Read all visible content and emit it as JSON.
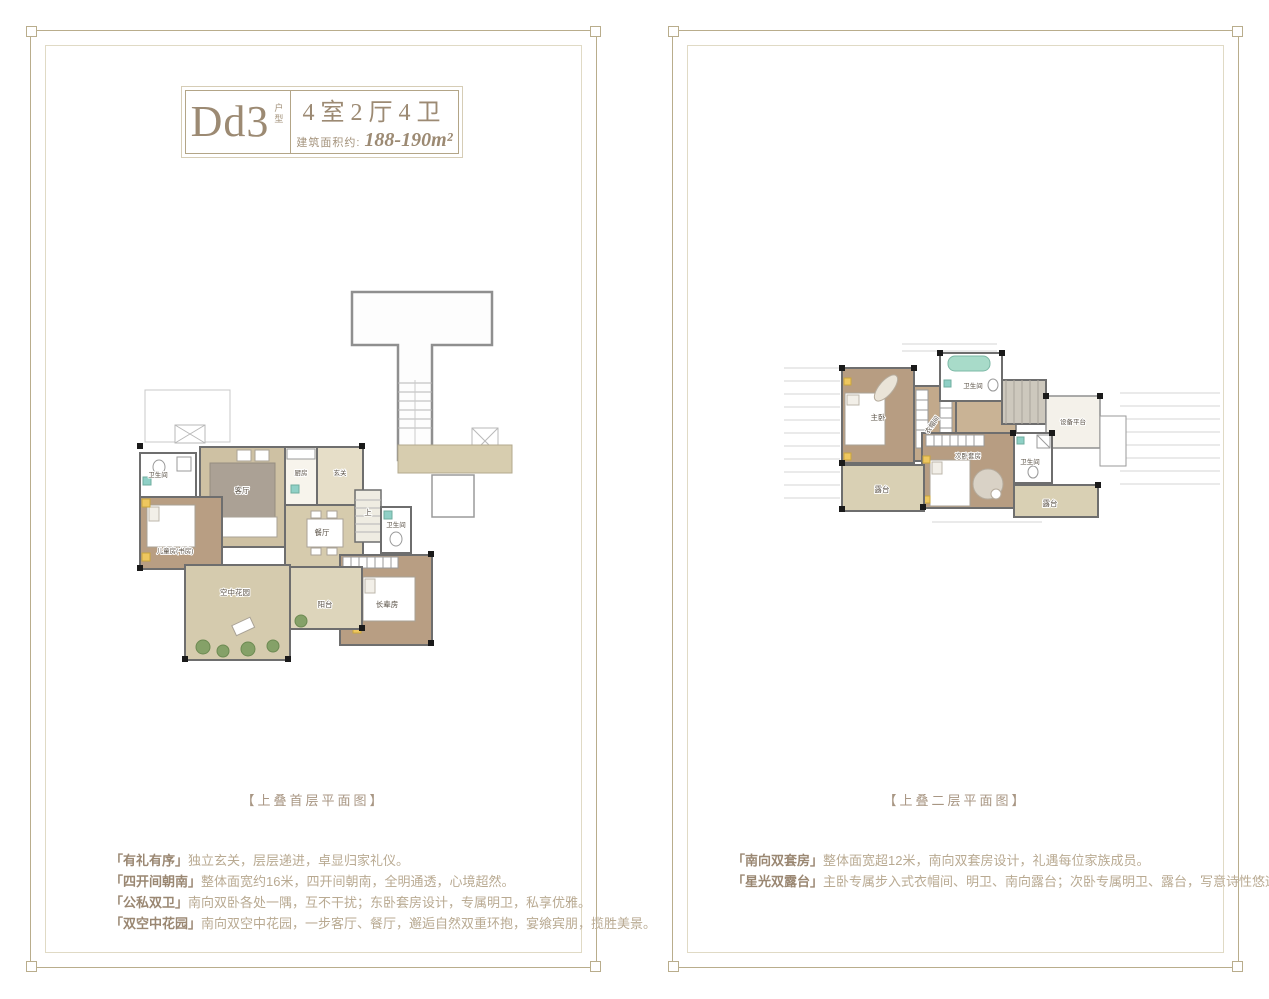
{
  "colors": {
    "frame_gold": "#b9ad8c",
    "frame_inner": "#e0dac5",
    "title_text": "#9c8a73",
    "feature_tag": "#9a8772",
    "feature_text": "#b9aa92",
    "caption_text": "#a89683",
    "wall": "#6e6e6e",
    "wood_floor": "#b79d82",
    "tan_floor": "#d6cbad",
    "plant_green": "#85a168",
    "accent_teal": "#8fd0c6",
    "accent_yellow": "#eec75f"
  },
  "left_panel": {
    "title_block": {
      "code": "Dd3",
      "code_suffix": "户型",
      "spec": "4室2厅4卫",
      "area_label": "建筑面积约:",
      "area_value": "188-190m²"
    },
    "caption": "【上叠首层平面图】",
    "features": [
      {
        "tag": "「有礼有序」",
        "text": "独立玄关，层层递进，卓显归家礼仪。"
      },
      {
        "tag": "「四开间朝南」",
        "text": "整体面宽约16米，四开间朝南，全明通透，心境超然。"
      },
      {
        "tag": "「公私双卫」",
        "text": "南向双卧各处一隅，互不干扰；东卧套房设计，专属明卫，私享优雅。"
      },
      {
        "tag": "「双空中花园」",
        "text": "南向双空中花园，一步客厅、餐厅，邂逅自然双重环抱，宴飨宾朋，揽胜美景。"
      }
    ],
    "rooms": {
      "bath1": "卫生间",
      "kids": "儿童房(书房)",
      "living": "客厅",
      "kitchen": "厨房",
      "foyer": "玄关",
      "dining": "餐厅",
      "stair_up": "上",
      "bath2": "卫生间",
      "elder": "长辈房",
      "garden": "空中花园",
      "balcony": "阳台"
    }
  },
  "right_panel": {
    "caption": "【上叠二层平面图】",
    "features": [
      {
        "tag": "「南向双套房」",
        "text": "整体面宽超12米，南向双套房设计，礼遇每位家族成员。"
      },
      {
        "tag": "「星光双露台」",
        "text": "主卧专属步入式衣帽间、明卫、南向露台；次卧专属明卫、露台，写意诗性悠远人生。"
      }
    ],
    "rooms": {
      "master": "主卧",
      "closet": "衣帽间",
      "bath_top": "卫生间",
      "equip": "设备平台",
      "second": "次卧套房",
      "bath_right": "卫生间",
      "terrace_left": "露台",
      "terrace_right": "露台"
    }
  }
}
